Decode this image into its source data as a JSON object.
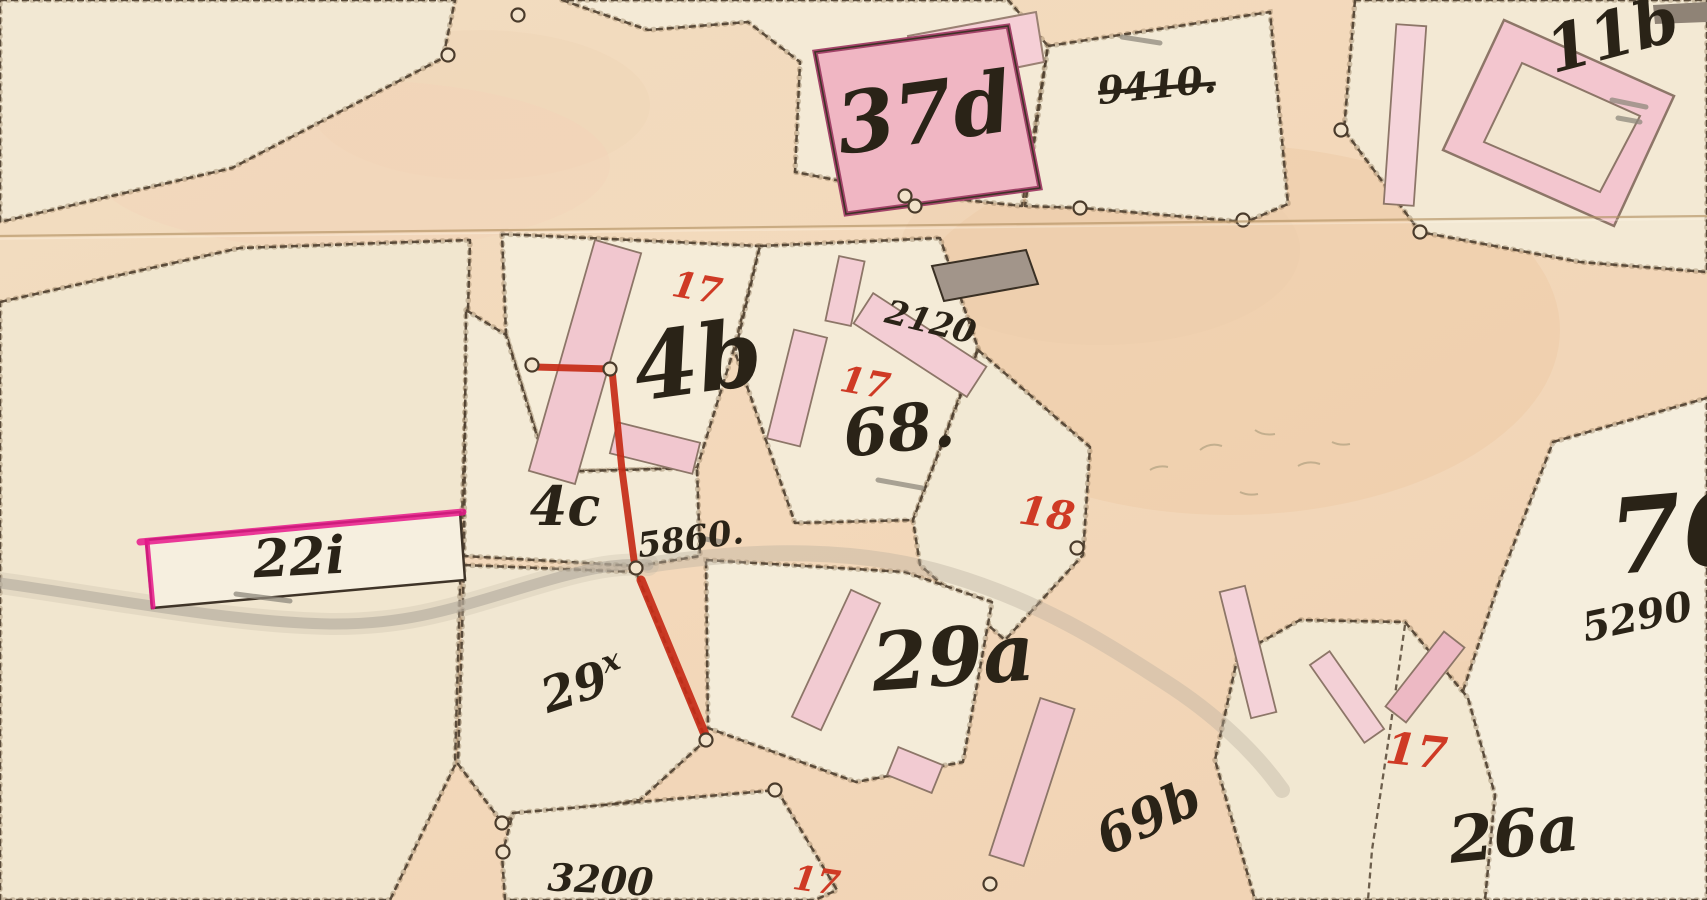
{
  "meta": {
    "sheet_type": "historical cadastral map scan",
    "width": 1707,
    "height": 900
  },
  "palette": {
    "paper_road": [
      "#f2ddc1",
      "#f3d8ba",
      "#f0d2b3"
    ],
    "parcel_cream": "#f3ead6",
    "boundary_ink": "#4a3b2b",
    "building_pink": "#f2c4cd",
    "building_pink_light": "#f5d3d9",
    "building_dark_roof": "#a2958a",
    "label_black": "#2a2317",
    "label_red": "#cf3a25",
    "survey_red_line": "#c62b17",
    "magenta_edge": "#e8188b",
    "stream_gray": "#b3aa9c",
    "fold_line": "#b49364",
    "pencil_gray": "#8f897d"
  },
  "map": {
    "blotches": [
      {
        "cx": 1230,
        "cy": 330,
        "rx": 330,
        "ry": 185,
        "fill": "#edcaa5",
        "op": 0.45
      },
      {
        "cx": 1100,
        "cy": 250,
        "rx": 200,
        "ry": 95,
        "fill": "#eccba8",
        "op": 0.3
      },
      {
        "cx": 480,
        "cy": 105,
        "rx": 170,
        "ry": 75,
        "fill": "#efd3b4",
        "op": 0.35
      },
      {
        "cx": 350,
        "cy": 165,
        "rx": 260,
        "ry": 85,
        "fill": "#f3d2b8",
        "op": 0.35
      },
      {
        "cx": 1500,
        "cy": 790,
        "rx": 230,
        "ry": 130,
        "fill": "#f0d0ae",
        "op": 0.3
      },
      {
        "cx": 200,
        "cy": 710,
        "rx": 260,
        "ry": 160,
        "fill": "#f2e2c9",
        "op": 0.3
      }
    ],
    "parcels": [
      {
        "name": "topleft-corner",
        "fill": "#f2e8d3",
        "points": "0,0 455,0 443,58 232,168 0,222"
      },
      {
        "name": "left-22i",
        "fill": "#f1e6cf",
        "points": "0,302 240,248 470,240 455,765 390,900 0,900"
      },
      {
        "name": "house-46",
        "fill": "#f5ecd8",
        "points": "502,234 760,246 733,352 697,468 548,472 506,334"
      },
      {
        "name": "strip-4c",
        "fill": "#f3ead6",
        "points": "466,310 506,335 548,472 697,468 700,556 638,566 464,556"
      },
      {
        "name": "strip-29x",
        "fill": "#f1e7d2",
        "points": "464,565 636,572 706,740 640,800 500,820 458,764"
      },
      {
        "name": "house-68",
        "fill": "#f4ebd7",
        "points": "760,246 940,238 978,348 913,520 795,523 735,352"
      },
      {
        "name": "parcel-18",
        "fill": "#f2e9d4",
        "points": "978,350 1090,447 1083,555 1005,640 920,565 913,520"
      },
      {
        "name": "house-29a",
        "fill": "#f4ecd9",
        "points": "706,560 905,572 992,602 963,762 856,782 708,728"
      },
      {
        "name": "bottom-3200",
        "fill": "#f2e8d3",
        "points": "513,813 777,790 837,890 815,900 505,900 502,855"
      },
      {
        "name": "top-37d",
        "fill": "#f4ead6",
        "points": "562,0 648,30 748,22 800,62 795,172 908,194 1022,206 1048,46 1008,0"
      },
      {
        "name": "top-9410",
        "fill": "#f3ead6",
        "points": "1048,46 1270,12 1288,204 1246,222 1082,208 1025,206"
      },
      {
        "name": "topright-11b",
        "fill": "#f3e9d4",
        "points": "1355,0 1344,130 1420,232 1580,262 1707,272 1707,0"
      },
      {
        "name": "east-76",
        "fill": "#f5eedd",
        "points": "1553,442 1707,398 1707,900 1408,900 1418,860 1460,700 1500,580"
      },
      {
        "name": "wedge-26a",
        "fill": "#f2e8d2",
        "points": "1238,655 1300,620 1405,622 1468,698 1495,795 1485,900 1255,900 1215,760"
      }
    ],
    "inner_edges": [
      {
        "name": "wedge-split",
        "points": "1405,625 1390,730 1372,850 1368,900"
      }
    ],
    "stream_paths": [
      {
        "d": "M0,583 C120,600 230,622 330,624 C420,625 470,602 560,577 C600,566 625,563 648,565",
        "w": 22,
        "color": "#c7bcaa",
        "op": 0.3
      },
      {
        "d": "M0,583 C120,600 230,622 330,624 C420,625 470,602 560,577 C600,566 625,563 648,565",
        "w": 11,
        "color": "#b3aa9c",
        "op": 0.6
      },
      {
        "d": "M648,565 C760,548 860,548 950,575 C1040,602 1100,640 1165,682 C1215,714 1255,752 1282,790",
        "w": 16,
        "color": "#b9ae9e",
        "op": 0.38
      }
    ],
    "buildings": [
      {
        "name": "building-46-wing",
        "cx": 585,
        "cy": 362,
        "w": 48,
        "h": 240,
        "rot": 16,
        "fill": "#f1c7cf"
      },
      {
        "name": "building-46-foot",
        "cx": 655,
        "cy": 448,
        "w": 85,
        "h": 32,
        "rot": 14,
        "fill": "#f1c7cf"
      },
      {
        "name": "building-46-sliver",
        "cx": 845,
        "cy": 291,
        "w": 26,
        "h": 66,
        "rot": 12,
        "fill": "#f3cdd4"
      },
      {
        "name": "building-68-left-bar",
        "cx": 797,
        "cy": 388,
        "w": 34,
        "h": 112,
        "rot": 14,
        "fill": "#f3cdd4"
      },
      {
        "name": "building-2120-bar",
        "cx": 920,
        "cy": 345,
        "w": 135,
        "h": 36,
        "rot": 33,
        "fill": "#f3cdd4"
      },
      {
        "name": "building-29a-bar",
        "cx": 836,
        "cy": 660,
        "w": 32,
        "h": 140,
        "rot": 25,
        "fill": "#f2cbd2"
      },
      {
        "name": "building-29a-square",
        "cx": 915,
        "cy": 770,
        "w": 48,
        "h": 30,
        "rot": 22,
        "fill": "#f2cbd2"
      },
      {
        "name": "building-69b-bar",
        "cx": 1032,
        "cy": 782,
        "w": 36,
        "h": 165,
        "rot": 18,
        "fill": "#f0c6ce"
      },
      {
        "name": "building-wedge-band-left",
        "cx": 1347,
        "cy": 697,
        "w": 24,
        "h": 95,
        "rot": -35,
        "fill": "#f3d0d6"
      },
      {
        "name": "building-wedge-band-right",
        "cx": 1425,
        "cy": 677,
        "w": 26,
        "h": 95,
        "rot": 38,
        "fill": "#edb9c4"
      },
      {
        "name": "building-arc-band",
        "cx": 1248,
        "cy": 652,
        "w": 26,
        "h": 130,
        "rot": -14,
        "fill": "#f4d2d8"
      },
      {
        "name": "building-11b-strip",
        "cx": 1405,
        "cy": 115,
        "w": 30,
        "h": 180,
        "rot": 4,
        "fill": "#f5d4da"
      }
    ],
    "poly_buildings": [
      {
        "name": "building-37d-upper",
        "points": "908,36 1036,12 1044,62 916,88",
        "fill": "#f5cfd6",
        "stroke": "#9a8173",
        "sw": 2
      },
      {
        "name": "building-37d-main",
        "points": "815,52 1008,26 1040,188 846,214",
        "fill": "#f0b6c3",
        "stroke": "#a4446a",
        "sw": 5
      },
      {
        "name": "building-37d-outline",
        "points": "815,52 1008,26 1040,188 846,214",
        "fill": "none",
        "stroke": "#3e3226",
        "sw": 1.6
      },
      {
        "name": "building-dark-roof",
        "points": "932,266 1026,250 1038,284 944,301",
        "fill": "#a2958a",
        "stroke": "#3a3024",
        "sw": 2
      },
      {
        "name": "building-11b-ring-outer",
        "points": "1443,150 1504,20 1674,96 1614,226",
        "fill": "#f3c6cf",
        "stroke": "#8d7668",
        "sw": 2.5
      },
      {
        "name": "building-11b-ring-inner",
        "points": "1484,142 1522,63 1640,116 1600,192",
        "fill": "#f2e6d0",
        "stroke": "#8d7668",
        "sw": 2
      },
      {
        "name": "building-22i",
        "points": "146,540 460,512 465,580 152,608",
        "fill": "#f6efdf",
        "stroke": "#3f3428",
        "sw": 2.5
      },
      {
        "name": "building-topright-gray-bar",
        "points": "1653,5 1707,2 1707,22 1655,24",
        "fill": "#8f8376",
        "stroke": "none",
        "sw": 0
      }
    ],
    "magenta_edges": [
      {
        "points": "140,542 463,512",
        "w": 7
      },
      {
        "points": "147,541 153,607",
        "w": 5
      }
    ],
    "red_lines": [
      {
        "points": "535,367 610,369",
        "w": 7
      },
      {
        "points": "612,370 622,470 634,560",
        "w": 7
      },
      {
        "points": "641,580 706,737",
        "w": 9
      }
    ],
    "survey_circles": [
      {
        "x": 448,
        "y": 55
      },
      {
        "x": 518,
        "y": 15
      },
      {
        "x": 532,
        "y": 365
      },
      {
        "x": 610,
        "y": 369
      },
      {
        "x": 636,
        "y": 568
      },
      {
        "x": 706,
        "y": 740
      },
      {
        "x": 775,
        "y": 790
      },
      {
        "x": 502,
        "y": 823
      },
      {
        "x": 503,
        "y": 852
      },
      {
        "x": 905,
        "y": 196
      },
      {
        "x": 915,
        "y": 206
      },
      {
        "x": 1080,
        "y": 208
      },
      {
        "x": 1243,
        "y": 220
      },
      {
        "x": 1341,
        "y": 130
      },
      {
        "x": 1420,
        "y": 232
      },
      {
        "x": 1077,
        "y": 548
      },
      {
        "x": 990,
        "y": 884
      }
    ],
    "pencil_marks": [
      {
        "x1": 236,
        "y1": 594,
        "x2": 290,
        "y2": 601
      },
      {
        "x1": 878,
        "y1": 480,
        "x2": 922,
        "y2": 488
      },
      {
        "x1": 1122,
        "y1": 37,
        "x2": 1160,
        "y2": 43
      },
      {
        "x1": 1612,
        "y1": 100,
        "x2": 1646,
        "y2": 107
      },
      {
        "x1": 1618,
        "y1": 118,
        "x2": 1640,
        "y2": 122
      },
      {
        "x1": 700,
        "y1": 538,
        "x2": 722,
        "y2": 542
      }
    ],
    "squiggles": [
      "M1200,450 q10,-8 22,-4",
      "M1255,430 q8,6 20,4",
      "M1298,466 q10,-6 22,-2",
      "M1332,442 q8,4 18,2",
      "M1150,470 q8,-5 18,-3",
      "M1240,492 q8,4 18,2"
    ],
    "labels": [
      {
        "text": "37d",
        "x": 928,
        "y": 142,
        "size": 84,
        "rot": -8,
        "color": "black"
      },
      {
        "text": "9410.",
        "x": 1158,
        "y": 98,
        "size": 38,
        "rot": -6,
        "color": "black",
        "strike": true
      },
      {
        "text": "11b",
        "x": 1618,
        "y": 56,
        "size": 64,
        "rot": -15,
        "color": "black"
      },
      {
        "text": "2120",
        "x": 928,
        "y": 333,
        "size": 33,
        "rot": 14,
        "color": "black"
      },
      {
        "text": "17",
        "x": 695,
        "y": 300,
        "size": 36,
        "rot": 10,
        "color": "red"
      },
      {
        "text": "4b",
        "x": 702,
        "y": 392,
        "size": 92,
        "rot": -8,
        "color": "black"
      },
      {
        "text": "17",
        "x": 863,
        "y": 395,
        "size": 36,
        "rot": 10,
        "color": "red"
      },
      {
        "text": "68.",
        "x": 901,
        "y": 451,
        "size": 64,
        "rot": -6,
        "color": "black"
      },
      {
        "text": "18",
        "x": 1045,
        "y": 527,
        "size": 40,
        "rot": 8,
        "color": "red"
      },
      {
        "text": "4c",
        "x": 565,
        "y": 525,
        "size": 54,
        "rot": 0,
        "color": "black"
      },
      {
        "text": "5860.",
        "x": 692,
        "y": 550,
        "size": 34,
        "rot": -8,
        "color": "black"
      },
      {
        "text": "22i",
        "x": 300,
        "y": 575,
        "size": 52,
        "rot": -3,
        "color": "black"
      },
      {
        "text": "29",
        "x": 588,
        "y": 700,
        "size": 48,
        "rot": -18,
        "color": "black",
        "sup": "x"
      },
      {
        "text": "29a",
        "x": 955,
        "y": 685,
        "size": 80,
        "rot": -4,
        "color": "black"
      },
      {
        "text": "69b",
        "x": 1156,
        "y": 833,
        "size": 52,
        "rot": -25,
        "color": "black"
      },
      {
        "text": "76",
        "x": 1685,
        "y": 568,
        "size": 104,
        "rot": -5,
        "color": "black"
      },
      {
        "text": "5290",
        "x": 1640,
        "y": 630,
        "size": 40,
        "rot": -12,
        "color": "black"
      },
      {
        "text": "17",
        "x": 1415,
        "y": 766,
        "size": 44,
        "rot": 6,
        "color": "red"
      },
      {
        "text": "26a",
        "x": 1516,
        "y": 856,
        "size": 64,
        "rot": -6,
        "color": "black"
      },
      {
        "text": "3200",
        "x": 600,
        "y": 893,
        "size": 38,
        "rot": 3,
        "color": "black"
      },
      {
        "text": "17",
        "x": 815,
        "y": 892,
        "size": 34,
        "rot": 8,
        "color": "red"
      }
    ],
    "fold_line": {
      "x1": 0,
      "y1": 236,
      "x2": 1707,
      "y2": 216
    }
  }
}
